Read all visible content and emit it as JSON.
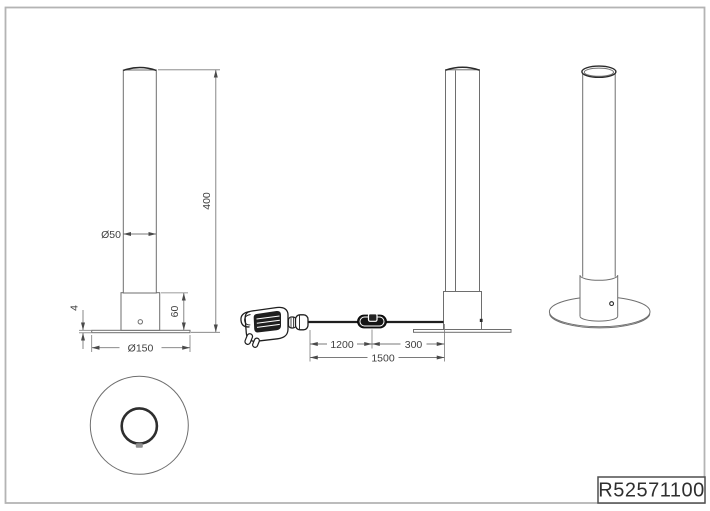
{
  "part_number": "R52571100",
  "dimensions": {
    "tube_diameter": "Ø50",
    "total_height": "400",
    "base_height": "60",
    "base_plate_thickness": "4",
    "base_plate_diameter": "Ø150",
    "plug_to_switch": "1200",
    "switch_to_base": "300",
    "cable_total_length": "1500"
  },
  "icons": {
    "plug": "power-plug-icon",
    "connector": "cable-connector-icon",
    "switch": "inline-switch-icon"
  },
  "colors": {
    "line": "#6e6e6e",
    "dark_line": "#2a2a2a",
    "dimension_line": "#7a7a7a",
    "dimension_text": "#3f3f3f",
    "frame": "#b4b4b4",
    "background": "#ffffff"
  }
}
